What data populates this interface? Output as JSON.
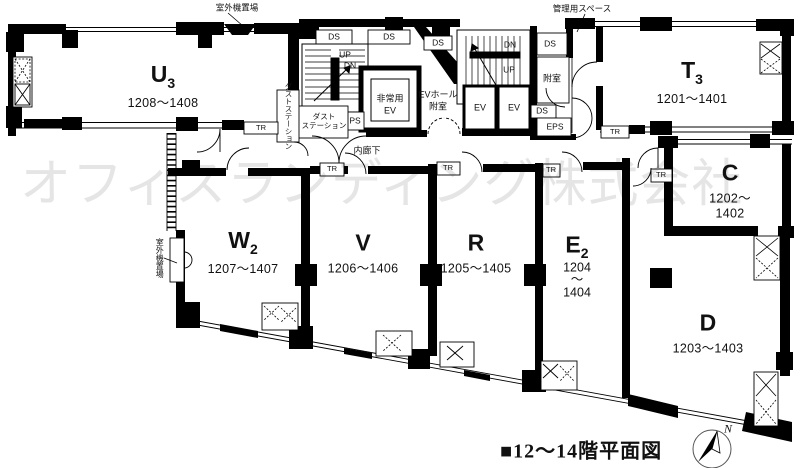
{
  "title": "■12〜14階平面図",
  "watermark": "オフィスランディング株式会社",
  "compass": {
    "north": "N"
  },
  "rooms": {
    "u3": {
      "main": "U",
      "sub": "3",
      "range": "1208〜1408"
    },
    "t3": {
      "main": "T",
      "sub": "3",
      "range": "1201〜1401"
    },
    "c": {
      "main": "C",
      "sub": "",
      "range": "1202〜1402"
    },
    "d": {
      "main": "D",
      "sub": "",
      "range": "1203〜1403"
    },
    "e2": {
      "main": "E",
      "sub": "2",
      "range_l1": "1204",
      "range_l2": "〜",
      "range_l3": "1404"
    },
    "r": {
      "main": "R",
      "sub": "",
      "range": "1205〜1405"
    },
    "v": {
      "main": "V",
      "sub": "",
      "range": "1206〜1406"
    },
    "w2": {
      "main": "W",
      "sub": "2",
      "range": "1207〜1407"
    }
  },
  "annotations": {
    "outdoor_unit_top": "室外機置場",
    "outdoor_unit_left": "室外機置場",
    "admin_space": "管理用スペース",
    "inner_corridor": "内廊下",
    "dust_station_v": "ダストステーション",
    "dust_station_h1": "ダスト",
    "dust_station_h2": "ステーション",
    "emergency_ev_l1": "非常用",
    "emergency_ev_l2": "EV",
    "ev_hall_l1": "EVホール",
    "ev_hall_l2": "附室",
    "anteroom": "附室",
    "up": "UP",
    "dn": "DN",
    "ev": "EV",
    "ps": "PS",
    "eps": "EPS",
    "ds": "DS",
    "tr": "TR"
  }
}
